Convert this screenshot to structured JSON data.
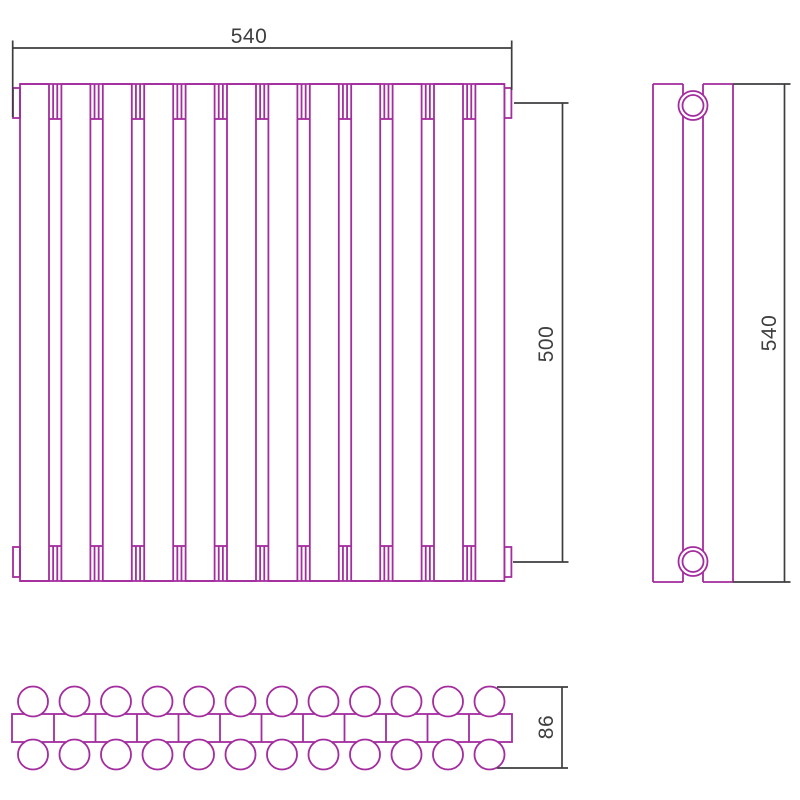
{
  "drawing": {
    "kind": "radiator technical drawing",
    "background": "#ffffff",
    "line_color": "#a32c9e",
    "dim_color": "#3e3e40"
  },
  "dimensions": {
    "overall_width": {
      "label": "540"
    },
    "connection_height": {
      "label": "500"
    },
    "side_height": {
      "label": "540"
    },
    "depth": {
      "label": "86"
    }
  },
  "views": {
    "front": {
      "name": "front view",
      "sections": 12
    },
    "side": {
      "name": "side view",
      "bushings": 2
    },
    "top": {
      "name": "top view",
      "tube_rows": 2,
      "tubes_per_row": 12
    }
  },
  "geometry": {
    "front": {
      "left": 20,
      "pitch": 41.4,
      "panel_w": 29,
      "sections": 12,
      "top": 84,
      "bottom": 581,
      "conn_top": 119,
      "conn_bot": 546,
      "tab": {
        "w": 7,
        "top_y": 88,
        "bot_y": 547,
        "h": 30
      }
    },
    "side": {
      "x1": 653,
      "x2": 733,
      "ix1": 683,
      "ix2": 703,
      "y1": 84,
      "y2": 582,
      "cx": 693,
      "r_out": 14.5,
      "r_in": 10.5,
      "cy_top": 105.5,
      "cy_bot": 561.5
    },
    "top_view": {
      "x1": 12,
      "x2": 512,
      "y1": 714,
      "y2": 742,
      "first_cx": 33,
      "pitch": 41.5,
      "count": 12,
      "r": 15,
      "cy_top": 701.5,
      "cy_bot": 754.5,
      "div_first": 54,
      "dividers": 11
    },
    "dims": [
      {
        "bind": "dimensions.overall_width.label",
        "name": "dim-overall-width",
        "lines": [
          [
            12.7,
            48,
            511.7,
            48
          ],
          [
            12.7,
            40.5,
            12.7,
            117
          ],
          [
            511.7,
            40.5,
            511.7,
            90
          ]
        ],
        "text": {
          "x": 249,
          "y": 43,
          "rotate": 0
        }
      },
      {
        "bind": "dimensions.connection_height.label",
        "name": "dim-connection-height",
        "lines": [
          [
            562.5,
            103,
            562.5,
            562
          ],
          [
            514,
            103,
            568.5,
            103
          ],
          [
            513,
            562,
            568.5,
            562
          ]
        ],
        "text": {
          "x": 553,
          "y": 344,
          "rotate": -90
        }
      },
      {
        "bind": "dimensions.side_height.label",
        "name": "dim-side-height",
        "lines": [
          [
            784.5,
            84,
            784.5,
            582
          ],
          [
            733,
            84,
            790.5,
            84
          ],
          [
            733,
            582,
            790.5,
            582
          ]
        ],
        "text": {
          "x": 776,
          "y": 333,
          "rotate": -90
        }
      },
      {
        "bind": "dimensions.depth.label",
        "name": "dim-depth",
        "lines": [
          [
            562,
            687,
            562,
            768
          ],
          [
            497,
            687,
            568,
            687
          ],
          [
            497,
            768,
            568,
            768
          ]
        ],
        "text": {
          "x": 553,
          "y": 727,
          "rotate": -90
        }
      }
    ]
  }
}
